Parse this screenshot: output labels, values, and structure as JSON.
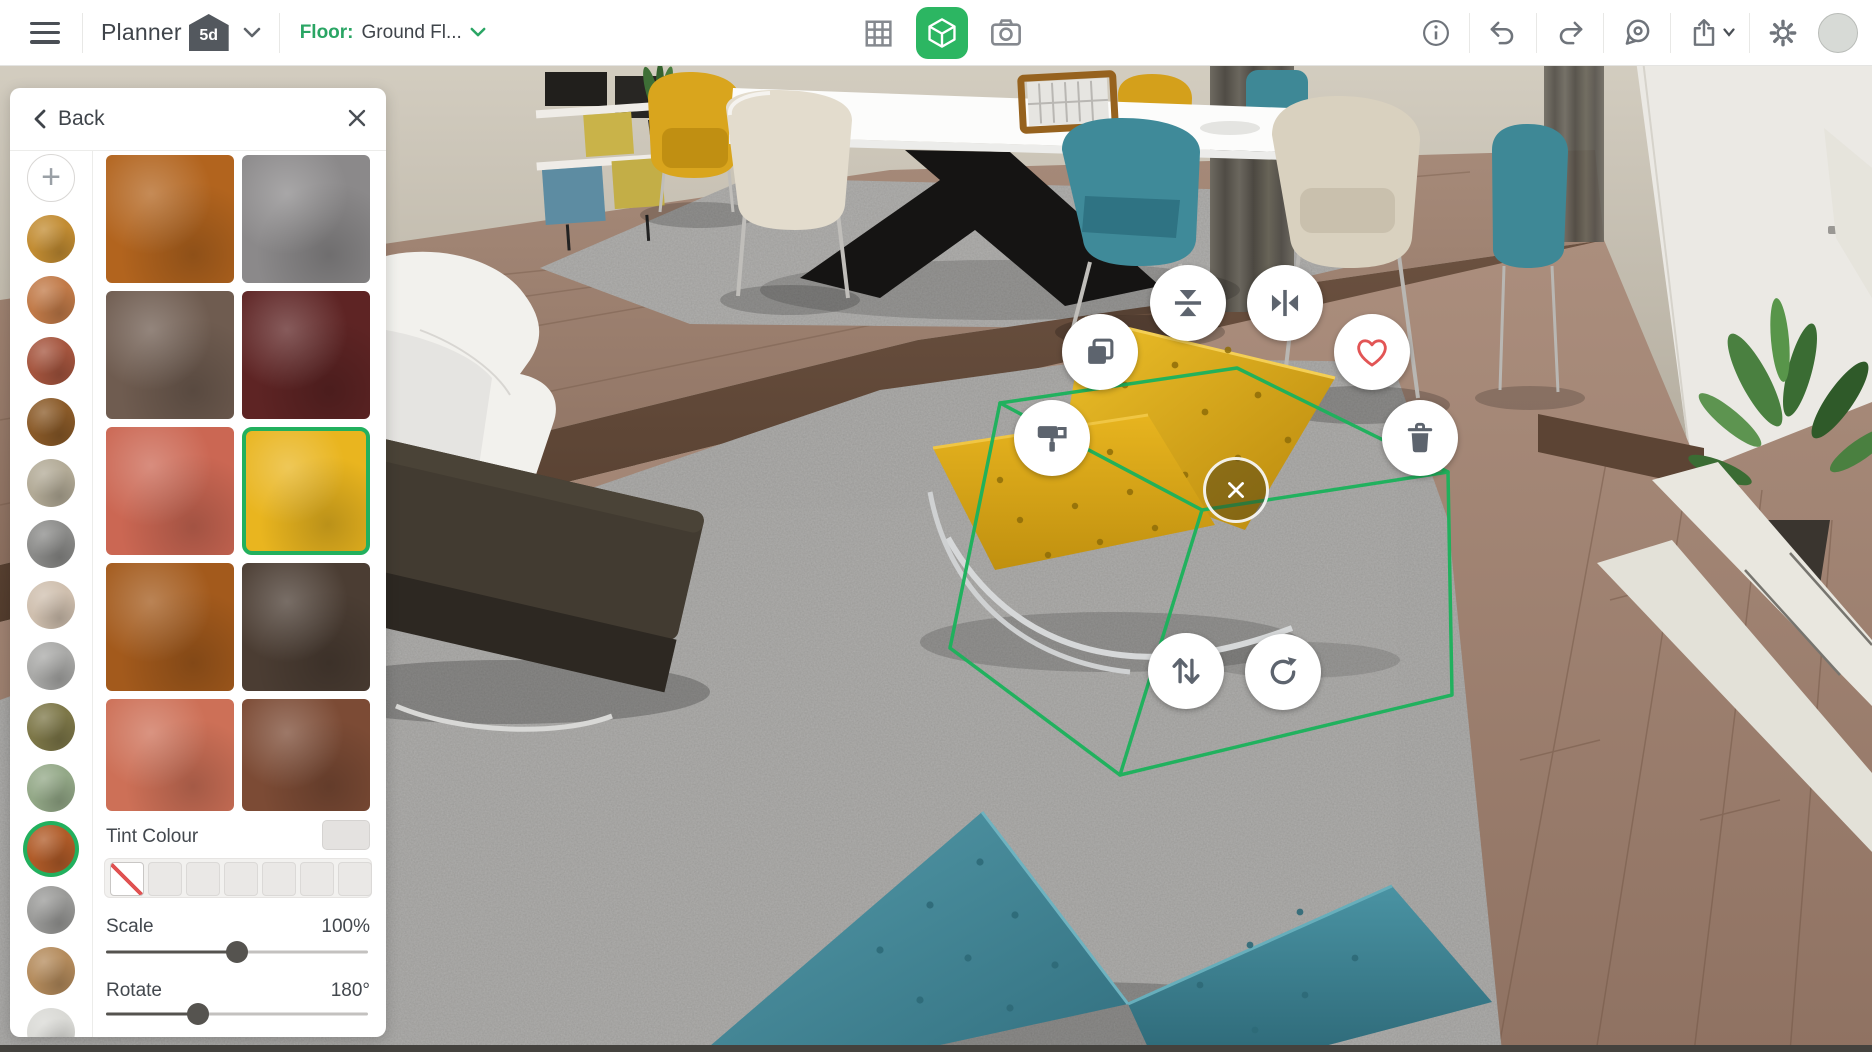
{
  "app": {
    "name": "Planner",
    "badge": "5d"
  },
  "topbar": {
    "floor_label": "Floor:",
    "floor_value": "Ground Fl...",
    "center_tools": [
      "2d-plan-view",
      "3d-view-active",
      "snapshot"
    ],
    "right_tools": [
      "info",
      "undo",
      "redo",
      "feedback",
      "export",
      "settings",
      "profile"
    ]
  },
  "panel": {
    "back_label": "Back",
    "column_swatches": [
      {
        "type": "add",
        "name": "add-texture"
      },
      {
        "name": "gold-stucco",
        "color": "#c28c32"
      },
      {
        "name": "mosaic-tile",
        "color": "#c17a48"
      },
      {
        "name": "red-brick",
        "color": "#a5553e"
      },
      {
        "name": "wood-planks",
        "color": "#8a5a28"
      },
      {
        "name": "pebbles",
        "color": "#b2aa96"
      },
      {
        "name": "grey-gravel",
        "color": "#8b8b89"
      },
      {
        "name": "beige-plaid",
        "color": "#cfbfae"
      },
      {
        "name": "grey-marble",
        "color": "#a9a9a7"
      },
      {
        "name": "green-medallion",
        "color": "#7d7748"
      },
      {
        "name": "green-vine-stone",
        "color": "#93a887"
      },
      {
        "name": "orange-leather",
        "color": "#b05b28",
        "selected": true
      },
      {
        "name": "grey-stone",
        "color": "#9a9a98"
      },
      {
        "name": "light-wood",
        "color": "#b48b5c"
      },
      {
        "name": "white-marble",
        "color": "#d9d9d5"
      }
    ],
    "grid_swatches": [
      {
        "name": "tan-leather",
        "color": "#b2641e"
      },
      {
        "name": "grey-leather",
        "color": "#8b898a"
      },
      {
        "name": "brown-suede",
        "color": "#6f5c50"
      },
      {
        "name": "maroon-leather",
        "color": "#5e2424"
      },
      {
        "name": "coral-leather",
        "color": "#cb6753"
      },
      {
        "name": "yellow-leather",
        "color": "#e9b51f",
        "selected": true
      },
      {
        "name": "amber-leather",
        "color": "#a35a1c"
      },
      {
        "name": "dark-brown-leather",
        "color": "#4b3d33"
      },
      {
        "name": "salmon-leather",
        "color": "#cd7057"
      },
      {
        "name": "mottled-brown-leather",
        "color": "#7c4b35"
      }
    ],
    "tint": {
      "label": "Tint Colour",
      "current_color": "#e4e2e0",
      "options": [
        {
          "name": "no-tint",
          "type": "none"
        },
        {
          "name": "tint-2",
          "color": "#eae8e6"
        },
        {
          "name": "tint-3",
          "color": "#eae8e6"
        },
        {
          "name": "tint-4",
          "color": "#eae8e6"
        },
        {
          "name": "tint-5",
          "color": "#eae8e6"
        },
        {
          "name": "tint-6",
          "color": "#eae8e6"
        },
        {
          "name": "tint-7",
          "color": "#eae8e6"
        }
      ]
    },
    "scale": {
      "label": "Scale",
      "value": "100%",
      "handle_position": "50%"
    },
    "rotate": {
      "label": "Rotate",
      "value": "180°",
      "handle_position": "35%"
    }
  },
  "selection": {
    "object": "yellow-tufted-lounge-chair",
    "buttons": [
      "duplicate",
      "flip-vertical",
      "flip-horizontal",
      "favourite",
      "material-paint",
      "delete",
      "deselect",
      "move-vertical",
      "rotate"
    ],
    "accent_color": "#1db25c",
    "favourite_color": "#e25555"
  },
  "colors": {
    "accent_green": "#2cb662",
    "floor_label_green": "#2aa564",
    "icon_grey": "#6f747b",
    "topbar_bg": "#ffffff",
    "panel_bg": "#ffffff"
  }
}
